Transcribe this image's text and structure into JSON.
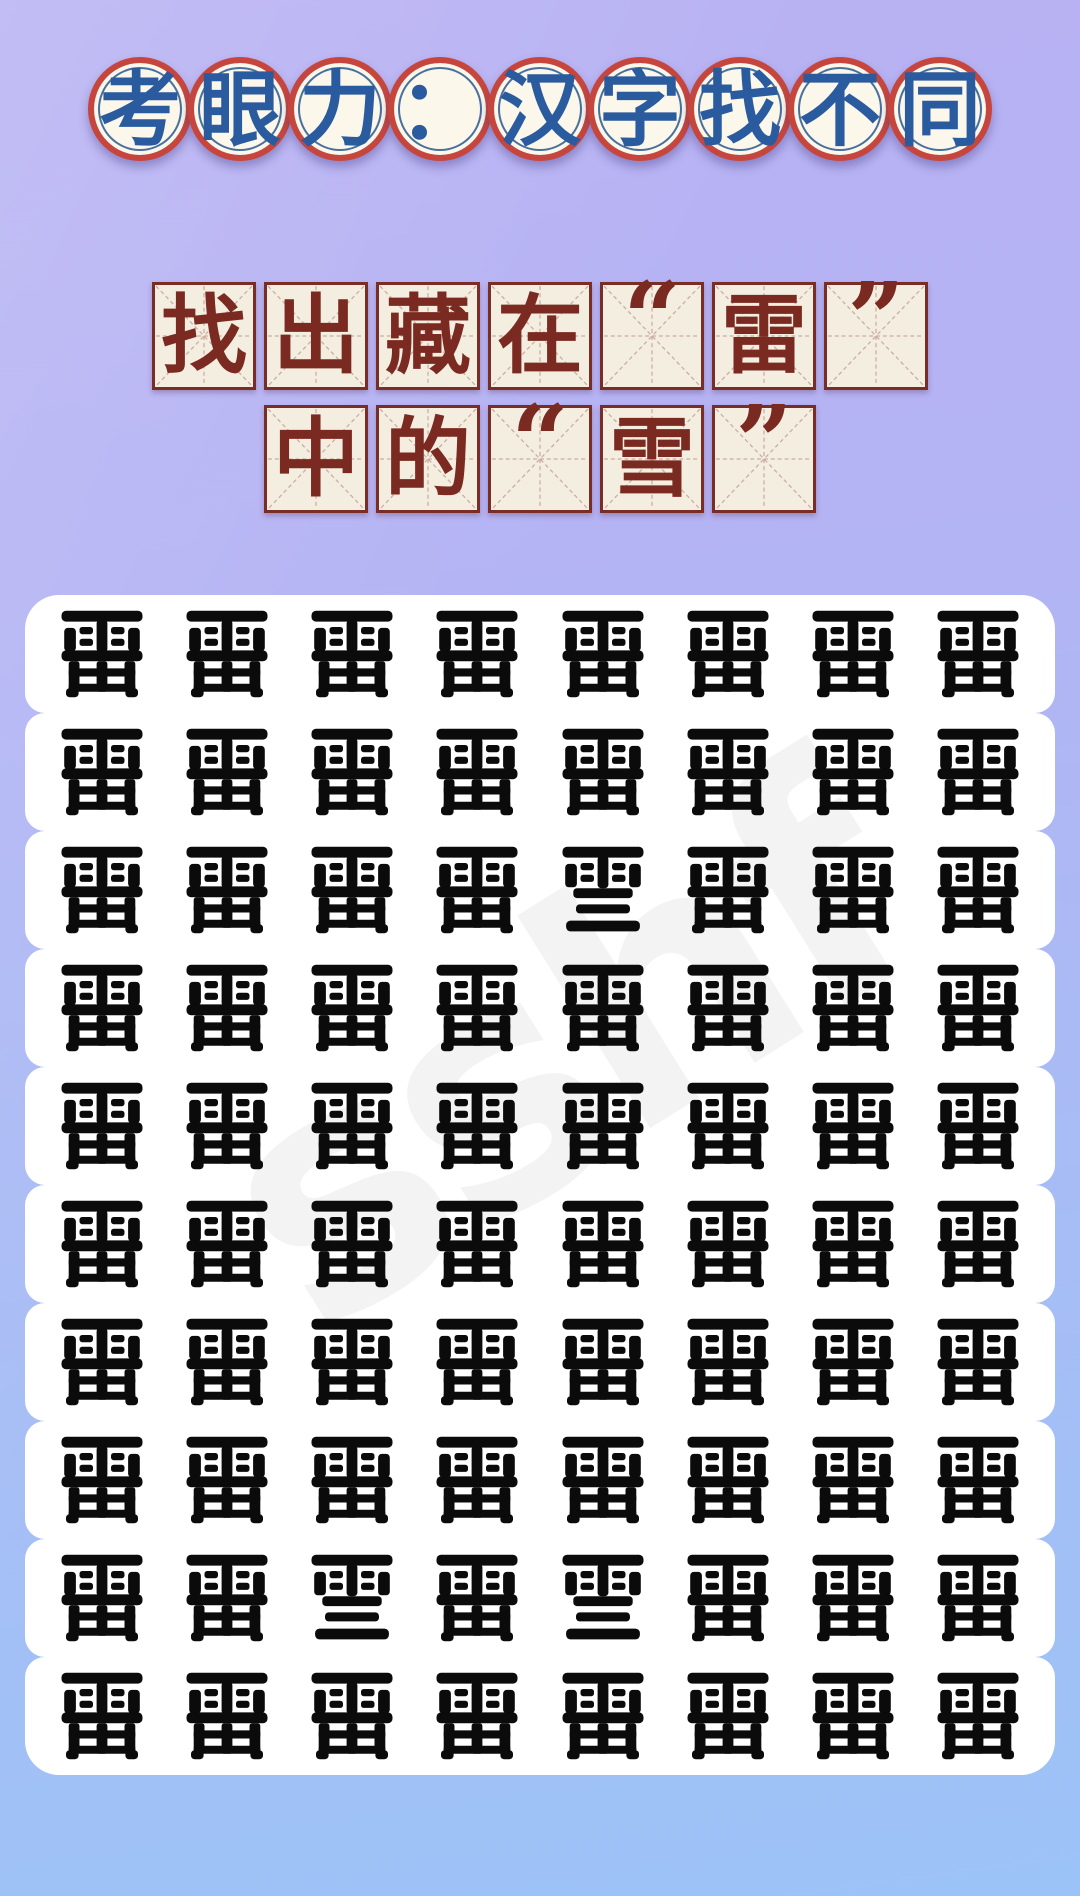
{
  "title": {
    "text": "考眼力：汉字找不同",
    "characters": [
      "考",
      "眼",
      "力",
      "：",
      "汉",
      "字",
      "找",
      "不",
      "同"
    ]
  },
  "subtitle": {
    "text": "找出藏在“雷”中的“雪”",
    "line1": [
      "找",
      "出",
      "藏",
      "在",
      "“",
      "雷",
      "”"
    ],
    "line2": [
      "中",
      "的",
      "“",
      "雪",
      "”"
    ]
  },
  "puzzle": {
    "rows": 10,
    "cols": 8,
    "base_char": "雷",
    "target_char": "雪",
    "grid": [
      [
        "雷",
        "雷",
        "雷",
        "雷",
        "雷",
        "雷",
        "雷",
        "雷"
      ],
      [
        "雷",
        "雷",
        "雷",
        "雷",
        "雷",
        "雷",
        "雷",
        "雷"
      ],
      [
        "雷",
        "雷",
        "雷",
        "雷",
        "雪",
        "雷",
        "雷",
        "雷"
      ],
      [
        "雷",
        "雷",
        "雷",
        "雷",
        "雷",
        "雷",
        "雷",
        "雷"
      ],
      [
        "雷",
        "雷",
        "雷",
        "雷",
        "雷",
        "雷",
        "雷",
        "雷"
      ],
      [
        "雷",
        "雷",
        "雷",
        "雷",
        "雷",
        "雷",
        "雷",
        "雷"
      ],
      [
        "雷",
        "雷",
        "雷",
        "雷",
        "雷",
        "雷",
        "雷",
        "雷"
      ],
      [
        "雷",
        "雷",
        "雷",
        "雷",
        "雷",
        "雷",
        "雷",
        "雷"
      ],
      [
        "雷",
        "雷",
        "雪",
        "雷",
        "雪",
        "雷",
        "雷",
        "雷"
      ],
      [
        "雷",
        "雷",
        "雷",
        "雷",
        "雷",
        "雷",
        "雷",
        "雷"
      ]
    ],
    "differences": [
      {
        "row": 3,
        "col": 5
      },
      {
        "row": 9,
        "col": 3
      },
      {
        "row": 9,
        "col": 5
      }
    ]
  },
  "watermark": {
    "text": "sshf"
  },
  "colors": {
    "background_top": "#b9b2f3",
    "background_bottom": "#9cc3f7",
    "title_ring_red": "#c6463e",
    "title_ring_blue": "#48719f",
    "title_circle_fill": "#fcf7eb",
    "title_char_blue": "#2a5b9e",
    "subtitle_box_fill": "#f3eee0",
    "subtitle_border": "#7a2d26",
    "subtitle_char": "#7b2a21",
    "card_fill": "#ffffff",
    "grid_char": "#0b0b0b"
  }
}
